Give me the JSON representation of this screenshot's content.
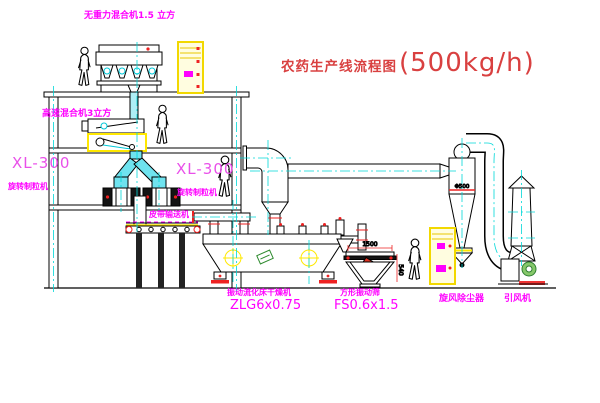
{
  "title": {
    "text_cn": "农药生产线流程图",
    "capacity": "(500kg/h)"
  },
  "equipment_labels": {
    "gravity_mixer": "无重力混合机1.5 立方",
    "high_speed_mixer": "高速混合机3立方",
    "granulator_left": {
      "model": "XL-300",
      "name": "旋转制粒机"
    },
    "granulator_right": {
      "model": "XL-300",
      "name": "旋转制粒机"
    },
    "belt_conveyor": "皮带输送机",
    "fluid_bed_dryer": {
      "name": "振动流化床干燥机",
      "model": "ZLG6x0.75"
    },
    "vibrating_sieve": {
      "name": "方形振动筛",
      "model": "FS0.6x1.5"
    },
    "cyclone": "旋风除尘器",
    "induced_draft_fan": "引风机"
  },
  "dimensions": {
    "sieve_width": "1500",
    "sieve_height": "540",
    "cyclone_marking": "Φ500"
  },
  "colors": {
    "title_red": "#d94040",
    "label_magenta": "#ff00ff",
    "centerline_cyan": "#00d8d8",
    "highlight_yellow": "#ffe800",
    "flange_red": "#ee2222",
    "motor_green": "#5aa83c"
  }
}
